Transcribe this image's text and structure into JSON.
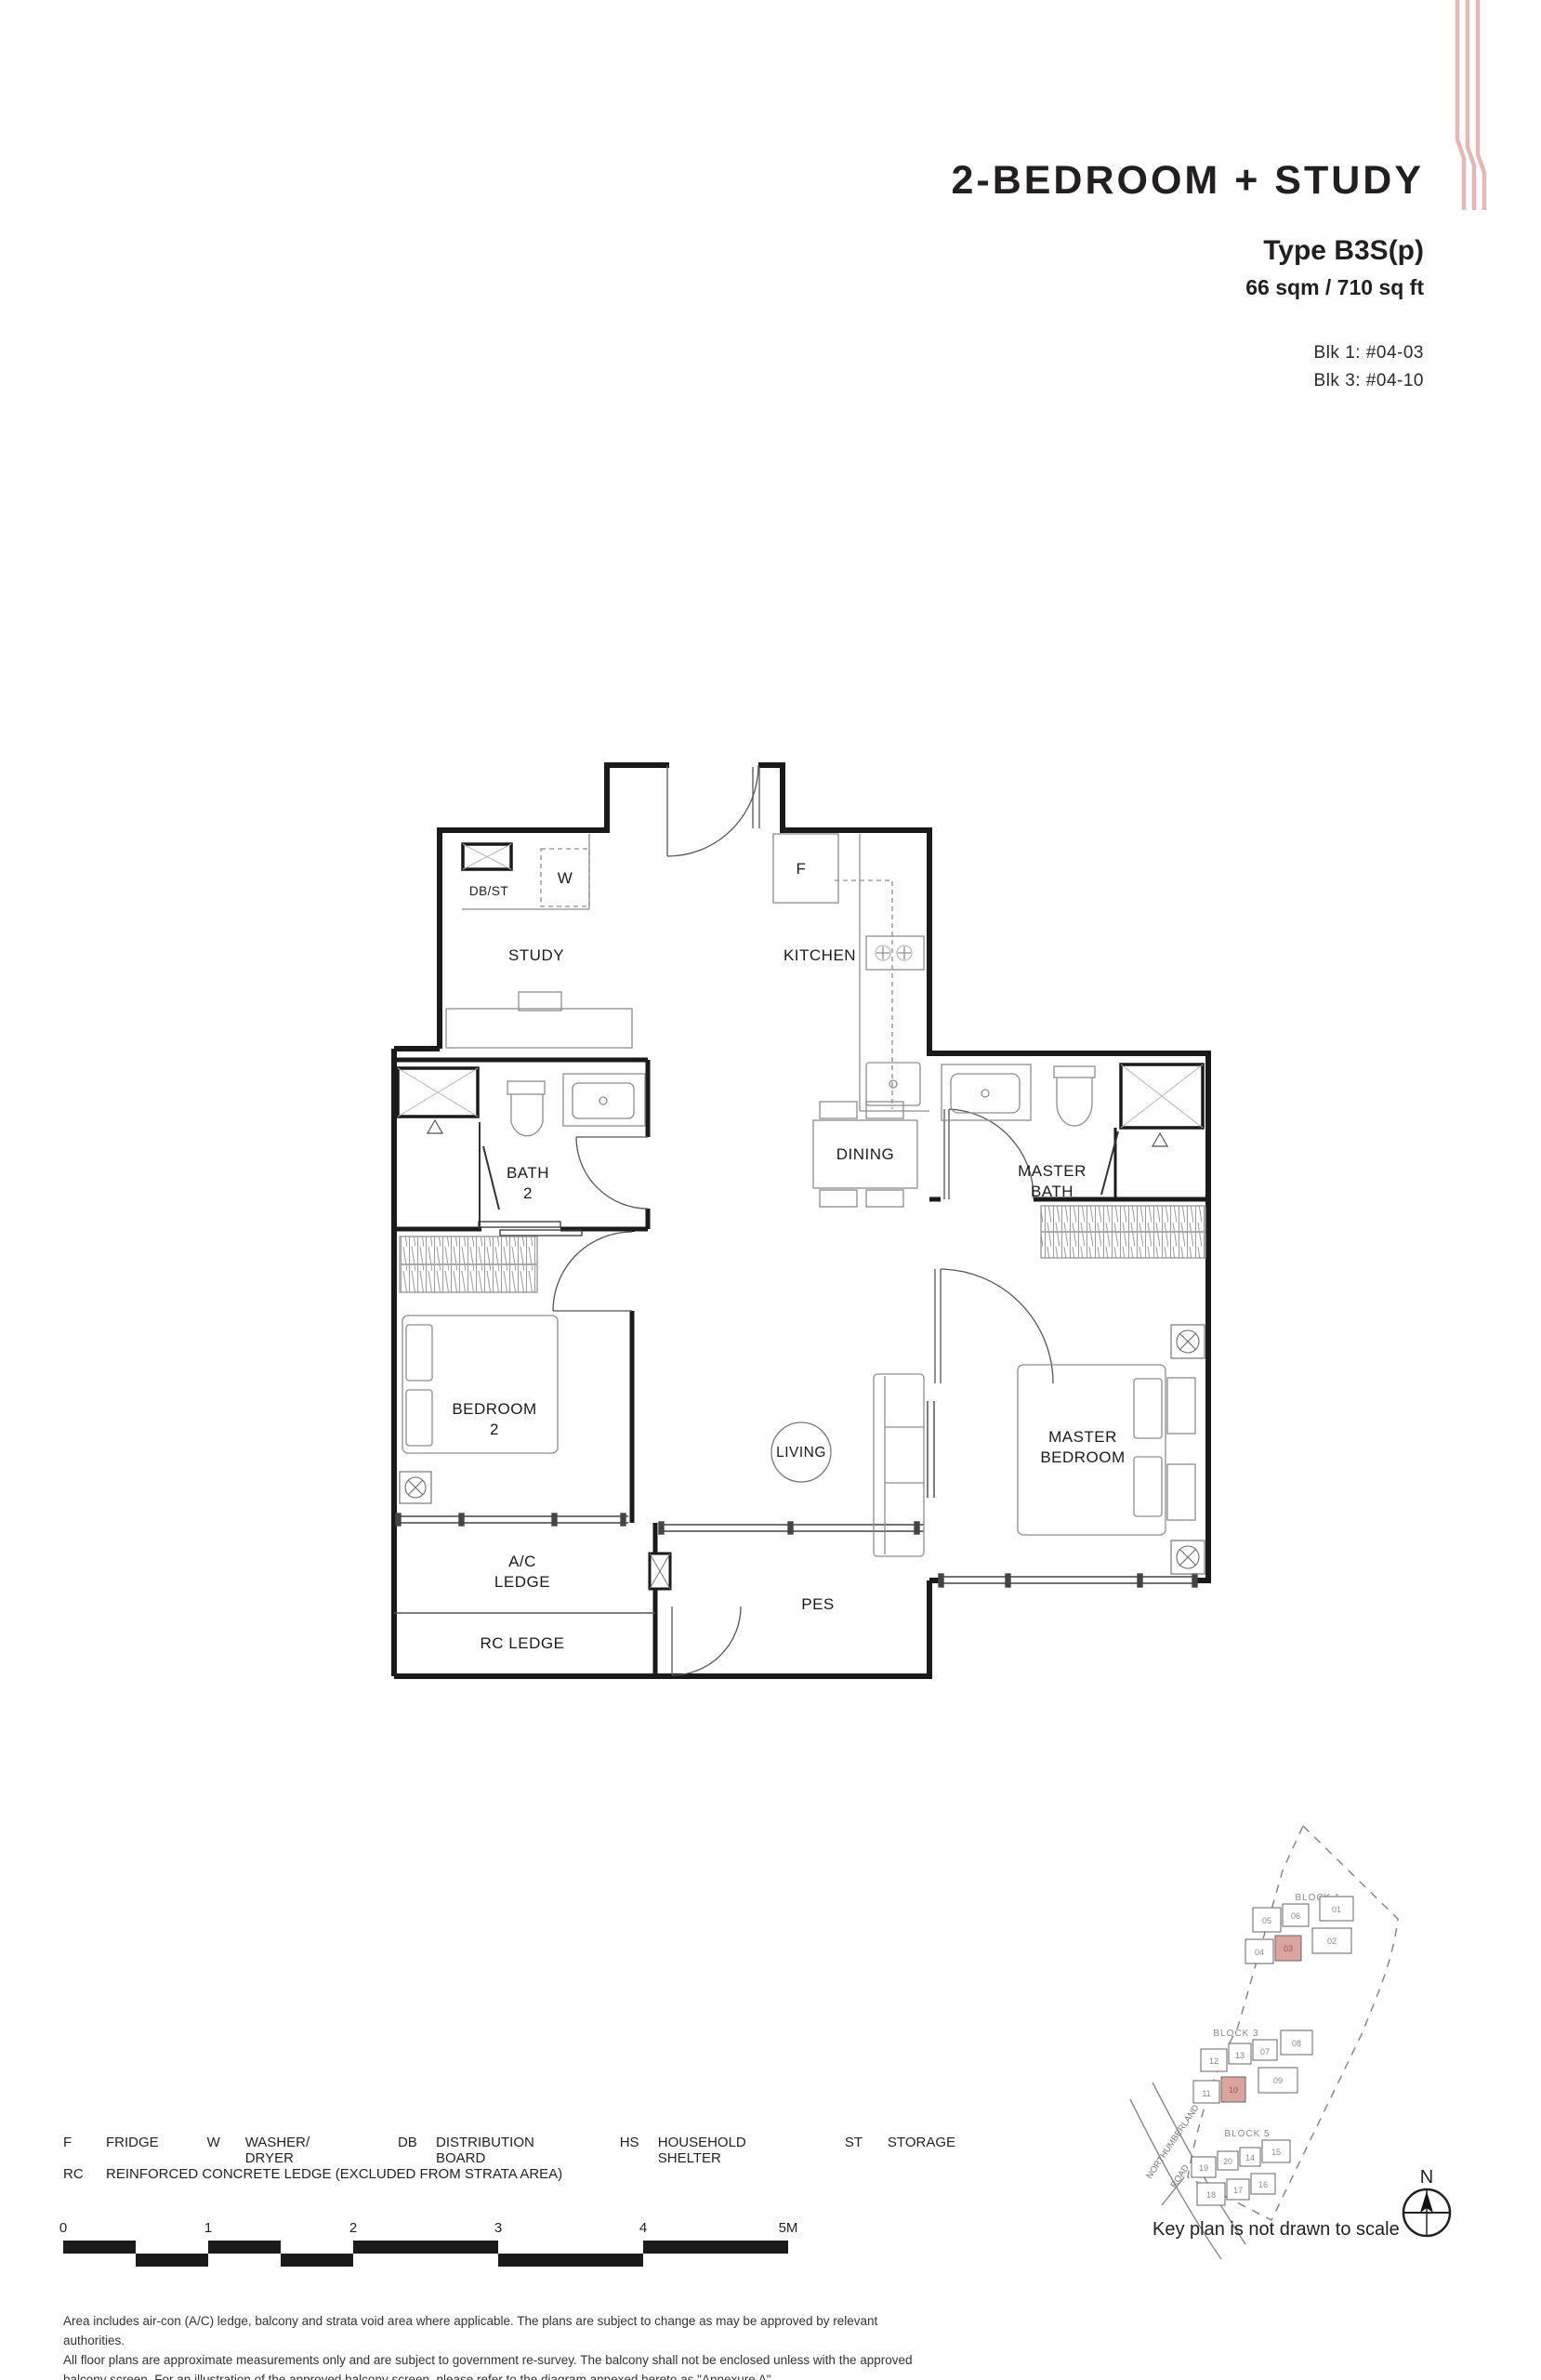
{
  "header": {
    "title": "2-BEDROOM + STUDY",
    "type": "Type B3S(p)",
    "area": "66 sqm / 710 sq ft",
    "unit1": "Blk 1: #04-03",
    "unit2": "Blk 3: #04-10"
  },
  "plan": {
    "rooms": {
      "study": "STUDY",
      "kitchen": "KITCHEN",
      "dining": "DINING",
      "living": "LIVING",
      "pes": "PES",
      "rc_ledge": "RC LEDGE",
      "ac_l1": "A/C",
      "ac_l2": "LEDGE",
      "bath2_l1": "BATH",
      "bath2_l2": "2",
      "master_bath_l1": "MASTER",
      "master_bath_l2": "BATH",
      "bedroom2_l1": "BEDROOM",
      "bedroom2_l2": "2",
      "master_bed_l1": "MASTER",
      "master_bed_l2": "BEDROOM"
    },
    "fixtures": {
      "washer": "W",
      "fridge": "F",
      "dbst": "DB/ST"
    }
  },
  "legend": {
    "items": [
      {
        "abbr": "F",
        "label": "FRIDGE"
      },
      {
        "abbr": "W",
        "label": "WASHER/ DRYER"
      },
      {
        "abbr": "DB",
        "label": "DISTRIBUTION BOARD"
      },
      {
        "abbr": "HS",
        "label": "HOUSEHOLD SHELTER"
      },
      {
        "abbr": "ST",
        "label": "STORAGE"
      }
    ],
    "rc": {
      "abbr": "RC",
      "label": "REINFORCED CONCRETE LEDGE (EXCLUDED FROM STRATA AREA)"
    }
  },
  "scalebar": {
    "ticks": [
      "0",
      "1",
      "2",
      "3",
      "4",
      "5M"
    ]
  },
  "disclaimer": [
    "Area includes air-con (A/C) ledge, balcony and strata void area where applicable. The plans are subject to change as may be approved by relevant authorities.",
    "All floor plans are approximate measurements only and are subject to government re-survey. The balcony shall not be enclosed unless with the approved",
    "balcony screen. For an illustration of the approved balcony screen, please refer to the diagram annexed hereto as \"Annexure A\"."
  ],
  "keyplan": {
    "caption": "Key plan is not drawn to scale",
    "north": "N",
    "road_l1": "NORTHUMBERLAND",
    "road_l2": "ROAD",
    "blocks": [
      {
        "name": "BLOCK 1",
        "units": [
          {
            "n": "05"
          },
          {
            "n": "06"
          },
          {
            "n": "01"
          },
          {
            "n": "04"
          },
          {
            "n": "03"
          },
          {
            "n": "02"
          }
        ]
      },
      {
        "name": "BLOCK 3",
        "units": [
          {
            "n": "12"
          },
          {
            "n": "13"
          },
          {
            "n": "07"
          },
          {
            "n": "08"
          },
          {
            "n": "11"
          },
          {
            "n": "10"
          },
          {
            "n": "09"
          }
        ]
      },
      {
        "name": "BLOCK 5",
        "units": [
          {
            "n": "19"
          },
          {
            "n": "20"
          },
          {
            "n": "14"
          },
          {
            "n": "15"
          },
          {
            "n": "18"
          },
          {
            "n": "17"
          },
          {
            "n": "16"
          }
        ]
      }
    ]
  }
}
